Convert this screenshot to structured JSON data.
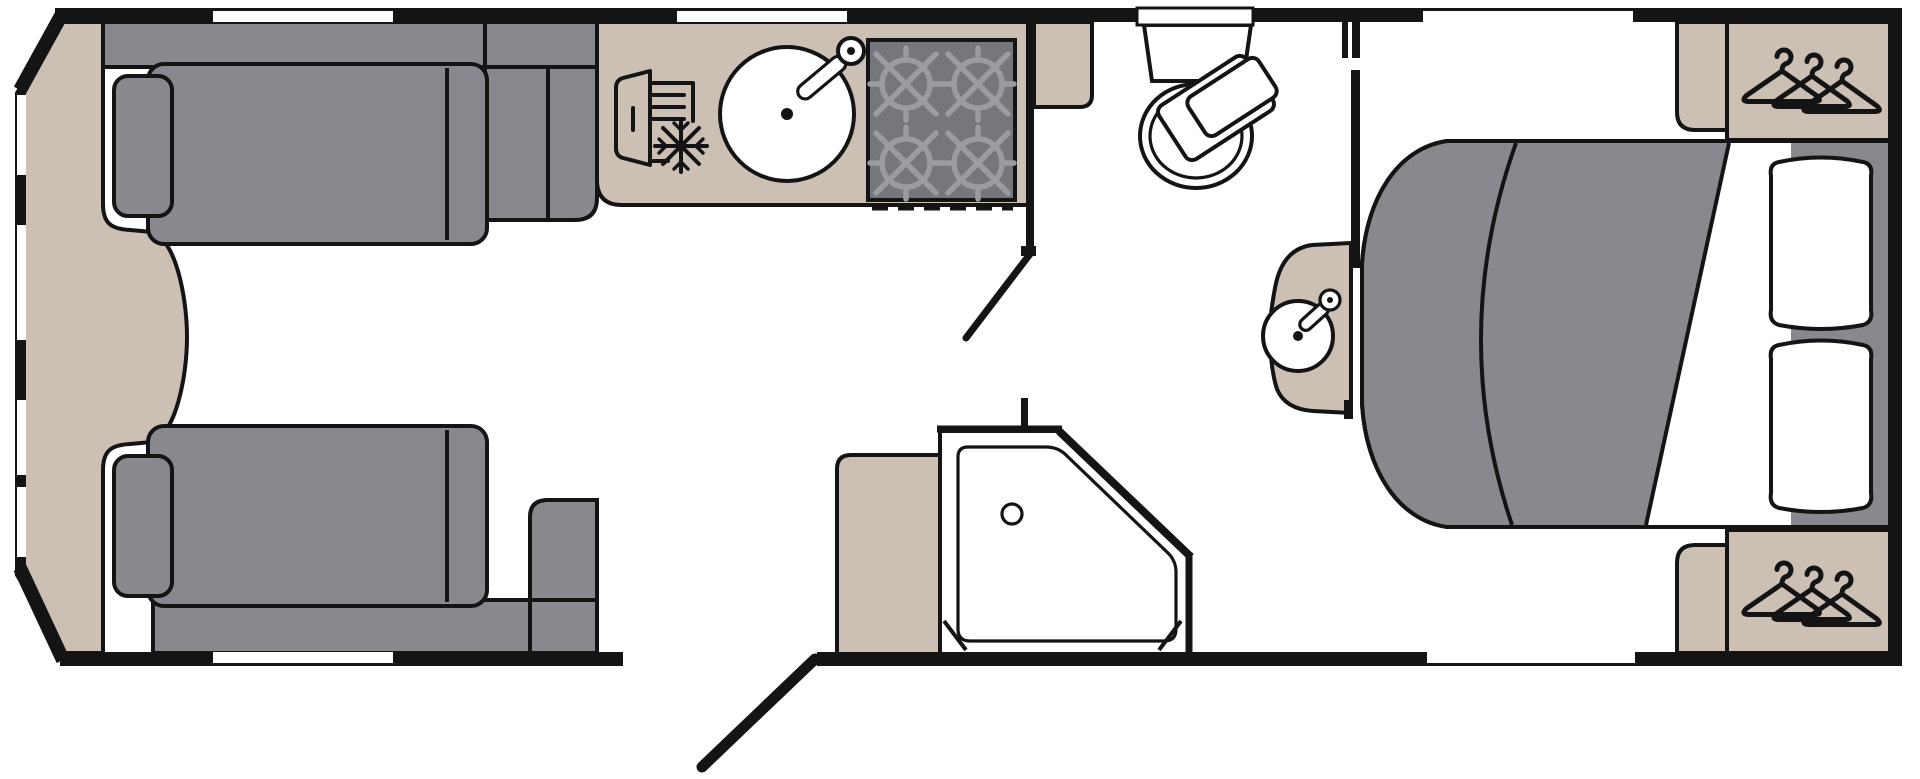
{
  "document": {
    "title": "Floor plan"
  },
  "colors": {
    "wall": "#141414",
    "floor": "#ffffff",
    "upholstery": "#87898e",
    "cabinetry": "#cbc0b3",
    "hob": "#75777c",
    "burner": "#9a9ca1"
  },
  "floorplan": {
    "type": "caravan-layout",
    "zones": [
      "front-lounge",
      "kitchen",
      "washroom",
      "bedroom"
    ],
    "fixtures": [
      {
        "zone": "front-lounge",
        "name": "front-chest"
      },
      {
        "zone": "front-lounge",
        "name": "sofa",
        "count": 2
      },
      {
        "zone": "kitchen",
        "name": "fridge-freezer",
        "icon": "snowflake-icon"
      },
      {
        "zone": "kitchen",
        "name": "sink",
        "icon": "round-sink-with-tap-icon"
      },
      {
        "zone": "kitchen",
        "name": "hob",
        "icon": "four-burner-icon"
      },
      {
        "zone": "washroom",
        "name": "toilet"
      },
      {
        "zone": "washroom",
        "name": "washbasin"
      },
      {
        "zone": "washroom",
        "name": "corner-shower",
        "icon": "drain-icon"
      },
      {
        "zone": "bedroom",
        "name": "island-bed",
        "pillows": 2
      },
      {
        "zone": "bedroom",
        "name": "wardrobe",
        "icon": "hanger-icon",
        "count": 2
      }
    ],
    "windows": {
      "front": 4,
      "top": 3,
      "bottom": 2,
      "above_toilet": 1
    },
    "doors": {
      "entrance": 1,
      "washroom": 1,
      "bedroom_sliding": 1
    }
  }
}
